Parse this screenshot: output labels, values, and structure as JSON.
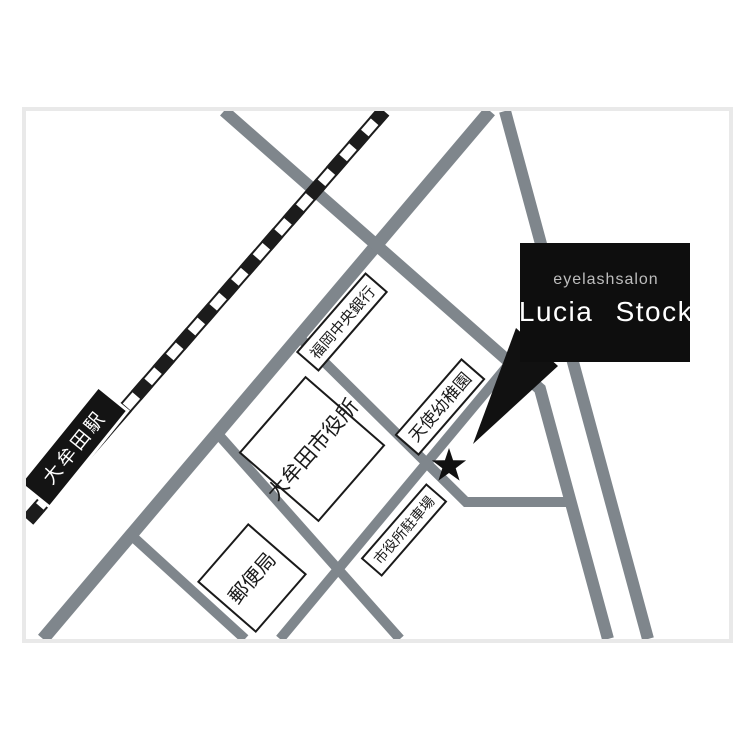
{
  "map": {
    "legend": {
      "brand": "eyelashsalon",
      "salon_name": "Lucia Stock"
    },
    "station": {
      "name": "大牟田駅"
    },
    "places": {
      "bank": "福岡中央銀行",
      "city_hall": "大牟田市役所",
      "kindergarten": "天使幼稚園",
      "parking": "市役所駐車場",
      "post_office": "郵便局"
    },
    "marker": {
      "type": "star"
    },
    "colors": {
      "road": "#7f868c",
      "railway": "#1c1c1c",
      "building_outline": "#1a1a1a",
      "salon_box": "#0e0e0e",
      "brand_text": "#bdbdbd",
      "salon_text": "#ffffff",
      "frame": "#e9e9e9"
    }
  }
}
